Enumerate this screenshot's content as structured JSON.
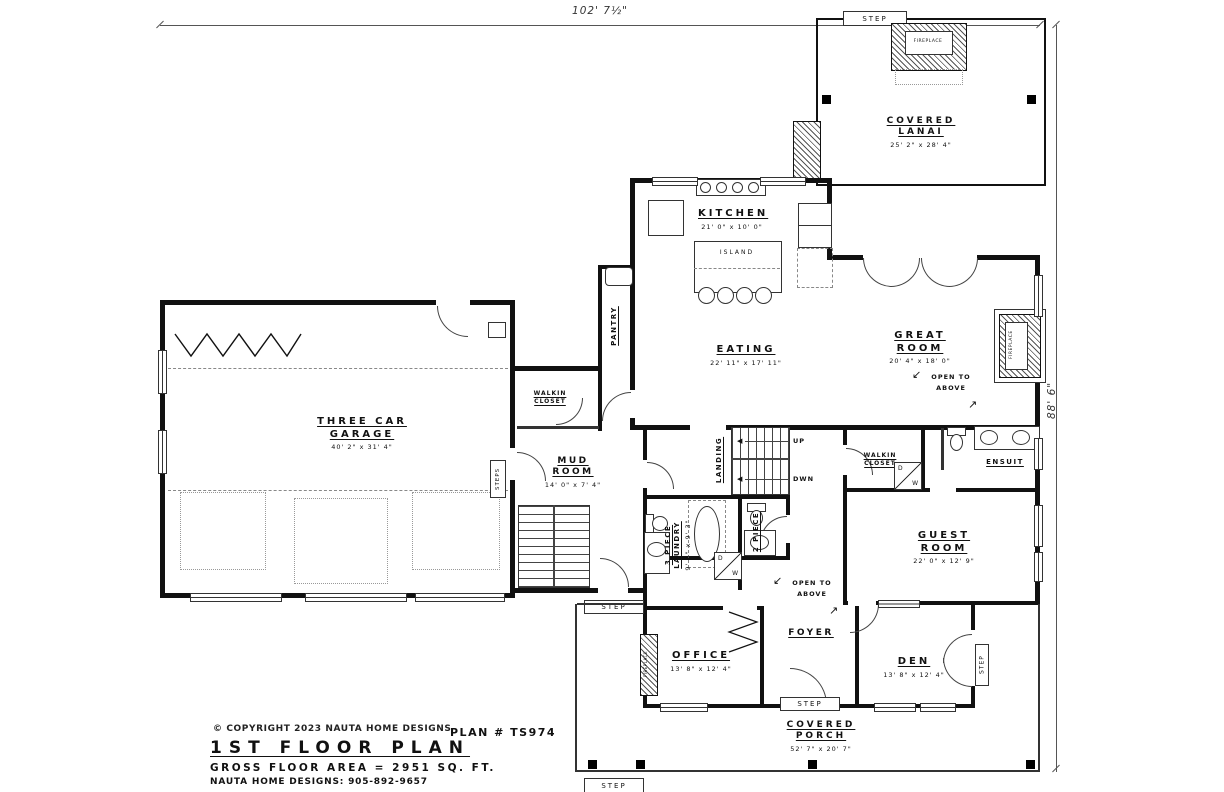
{
  "drawing": {
    "dim_width": "102' 7½\"",
    "dim_height": "88' 6\""
  },
  "rooms": {
    "covered_lanai": {
      "name": "COVERED LANAI",
      "dims": "25' 2\" x 28' 4\""
    },
    "kitchen": {
      "name": "KITCHEN",
      "dims": "21' 0\" x 10' 0\""
    },
    "eating": {
      "name": "EATING",
      "dims": "22' 11\" x 17' 11\""
    },
    "great_room": {
      "name": "GREAT ROOM",
      "dims": "20' 4\" x 18' 0\""
    },
    "pantry": {
      "name": "PANTRY"
    },
    "three_car_garage": {
      "name": "THREE CAR GARAGE",
      "dims": "40' 2\" x 31' 4\""
    },
    "mud_room": {
      "name": "MUD ROOM",
      "dims": "14' 0\" x 7' 4\""
    },
    "walkin_closet_mud": {
      "name": "WALKIN CLOSET"
    },
    "landing": {
      "name": "LANDING"
    },
    "laundry": {
      "name": "3 PIECE LAUNDRY",
      "dims": "9' 4\" x 9' 3\""
    },
    "two_piece": {
      "name": "2 PIECE"
    },
    "walkin_closet_guest": {
      "name": "WALKIN CLOSET"
    },
    "ensuite": {
      "name": "ENSUIT"
    },
    "guest_room": {
      "name": "GUEST ROOM",
      "dims": "22' 0\" x 12' 9\""
    },
    "office": {
      "name": "OFFICE",
      "dims": "13' 8\" x 12' 4\""
    },
    "foyer": {
      "name": "FOYER"
    },
    "den": {
      "name": "DEN",
      "dims": "13' 8\" x 12' 4\""
    },
    "covered_porch": {
      "name": "COVERED PORCH",
      "dims": "52' 7\" x 20' 7\""
    }
  },
  "annotations": {
    "open_to_above": "OPEN TO ABOVE",
    "island": "ISLAND",
    "fireplace": "FIREPLACE",
    "up": "UP",
    "down": "DWN",
    "step": "STEP",
    "steps": "STEPS",
    "dryer_letter": "D",
    "washer_letter": "W"
  },
  "icons": {
    "arrow_down_left": "↙",
    "arrow_up_right": "↗",
    "arrow_left": "◀",
    "copyright": "©"
  },
  "title_block": {
    "copyright": "COPYRIGHT 2023 NAUTA HOME DESIGNS",
    "plan_number": "PLAN # TS974",
    "title": "1ST FLOOR PLAN",
    "gross_area": "GROSS FLOOR AREA = 2951 SQ. FT.",
    "contact": "NAUTA HOME DESIGNS: 905-892-9657"
  }
}
